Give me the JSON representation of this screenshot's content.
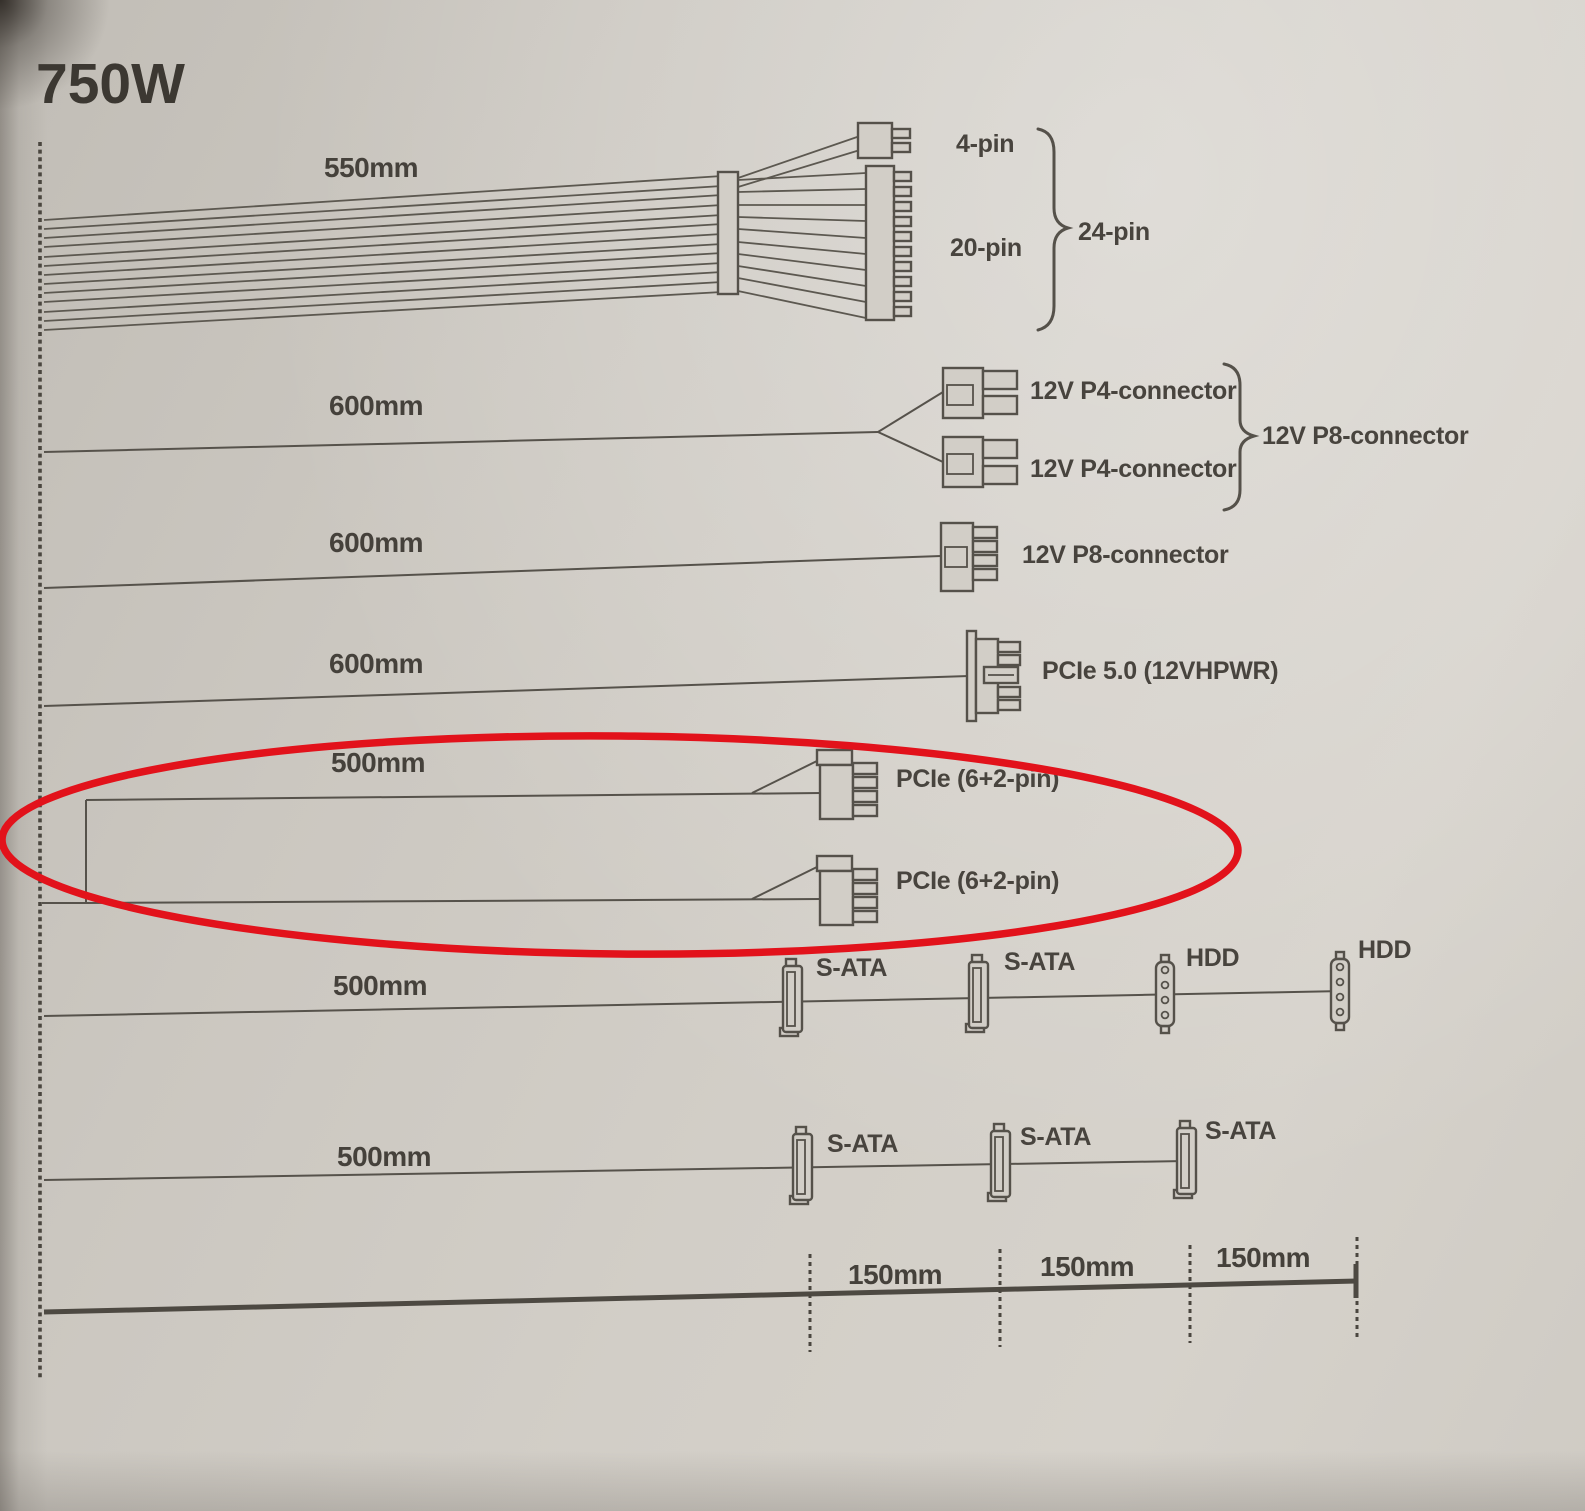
{
  "title": "750W",
  "rows": [
    {
      "length": "550mm",
      "parts": [
        "4-pin",
        "20-pin"
      ],
      "brace": "24-pin"
    },
    {
      "length": "600mm",
      "parts": [
        "12V P4-connector",
        "12V P4-connector"
      ],
      "brace": "12V P8-connector"
    },
    {
      "length": "600mm",
      "parts": [
        "12V P8-connector"
      ]
    },
    {
      "length": "600mm",
      "parts": [
        "PCIe 5.0 (12VHPWR)"
      ]
    },
    {
      "length": "500mm",
      "parts": [
        "PCIe (6+2-pin)",
        "PCIe (6+2-pin)"
      ]
    },
    {
      "length": "500mm",
      "parts": [
        "S-ATA",
        "S-ATA",
        "HDD",
        "HDD"
      ]
    },
    {
      "length": "500mm",
      "parts": [
        "S-ATA",
        "S-ATA",
        "S-ATA"
      ]
    }
  ],
  "ruler": {
    "segments": [
      "150mm",
      "150mm",
      "150mm"
    ]
  },
  "annotation": {
    "shape": "ellipse",
    "color": "#e2121b",
    "highlights": "PCIe (6+2-pin) cables"
  }
}
